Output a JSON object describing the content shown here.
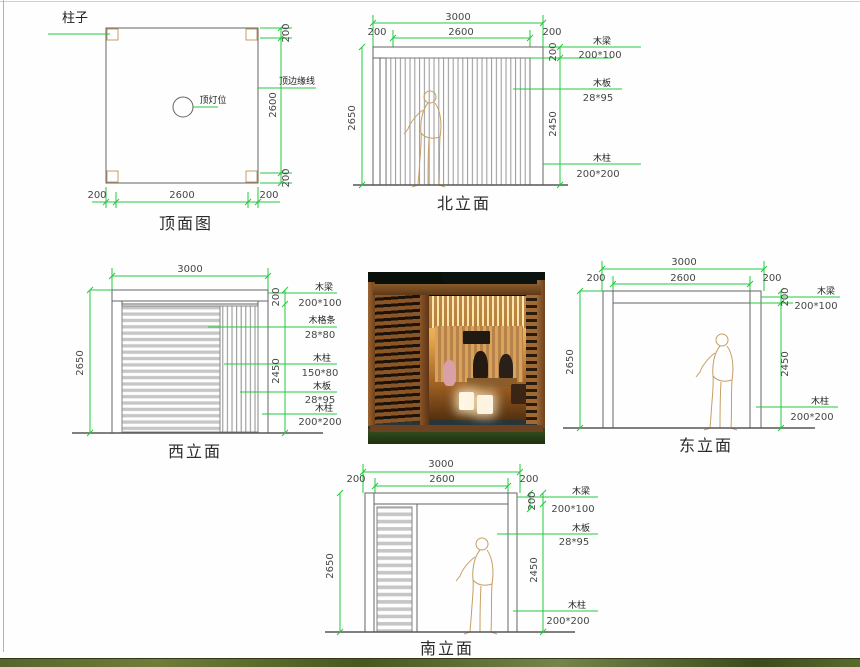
{
  "colors": {
    "dimension_green": "#22c93e",
    "drawing_gray": "#646464",
    "sketch_tan": "#c79e62"
  },
  "plan_view": {
    "title": "顶面图",
    "labels": {
      "column": "柱子",
      "ceiling_light": "顶灯位",
      "top_edge": "顶边缘线"
    },
    "dims": {
      "bottom_left": "200",
      "bottom_middle": "2600",
      "bottom_right": "200",
      "right_top": "200",
      "right_middle": "2600",
      "right_bottom": "200"
    }
  },
  "north_elevation": {
    "title": "北立面",
    "dims": {
      "overall_width": "3000",
      "left_offset": "200",
      "inner_width": "2600",
      "right_offset": "200",
      "overall_height": "2650",
      "beam_depth": "200",
      "clear_height": "2450"
    },
    "callouts": [
      {
        "part": "木梁",
        "size": "200*100"
      },
      {
        "part": "木板",
        "size": "28*95"
      },
      {
        "part": "木柱",
        "size": "200*200"
      }
    ]
  },
  "west_elevation": {
    "title": "西立面",
    "dims": {
      "overall_width": "3000",
      "overall_height": "2650",
      "beam_depth": "200",
      "clear_height": "2450"
    },
    "callouts": [
      {
        "part": "木梁",
        "size": "200*100"
      },
      {
        "part": "木格条",
        "size": "28*80"
      },
      {
        "part": "木柱",
        "size": "150*80"
      },
      {
        "part": "木板",
        "size": "28*95"
      },
      {
        "part": "木柱",
        "size": "200*200"
      }
    ]
  },
  "east_elevation": {
    "title": "东立面",
    "dims": {
      "overall_width": "3000",
      "left_offset": "200",
      "inner_width": "2600",
      "right_offset": "200",
      "overall_height": "2650",
      "beam_depth": "200",
      "clear_height": "2450"
    },
    "callouts": [
      {
        "part": "木梁",
        "size": "200*100"
      },
      {
        "part": "木柱",
        "size": "200*200"
      }
    ]
  },
  "south_elevation": {
    "title": "南立面",
    "dims": {
      "overall_width": "3000",
      "left_offset": "200",
      "inner_width": "2600",
      "right_offset": "200",
      "overall_height": "2650",
      "beam_depth": "200",
      "clear_height": "2450"
    },
    "callouts": [
      {
        "part": "木梁",
        "size": "200*100"
      },
      {
        "part": "木板",
        "size": "28*95"
      },
      {
        "part": "木柱",
        "size": "200*200"
      }
    ]
  }
}
